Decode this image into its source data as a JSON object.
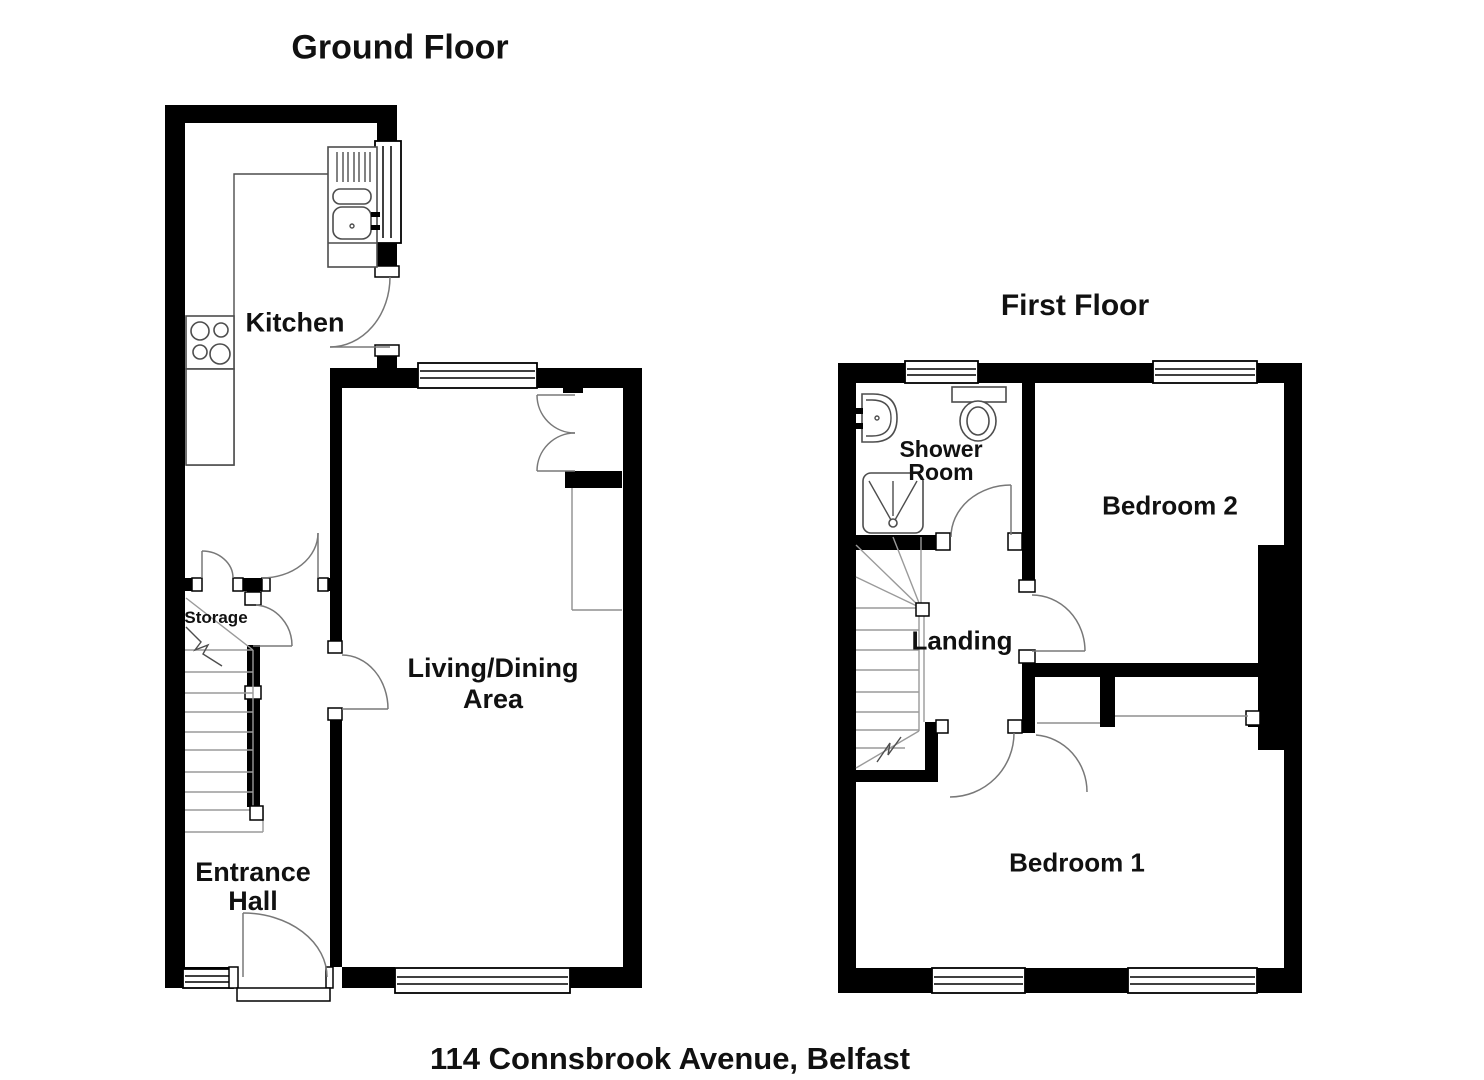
{
  "colors": {
    "background": "#ffffff",
    "walls": "#000000",
    "thin_lines": "#8f8f8f",
    "text": "#111111"
  },
  "address": "114 Connsbrook Avenue, Belfast",
  "ground_floor": {
    "title": "Ground Floor",
    "rooms": {
      "kitchen": {
        "label": "Kitchen"
      },
      "living": {
        "lines": [
          "Living/Dining",
          "Area"
        ]
      },
      "storage": {
        "label": "Storage"
      },
      "entrance": {
        "lines": [
          "Entrance",
          "Hall"
        ]
      }
    }
  },
  "first_floor": {
    "title": "First Floor",
    "rooms": {
      "shower": {
        "lines": [
          "Shower",
          "Room"
        ]
      },
      "bedroom2": {
        "label": "Bedroom 2"
      },
      "landing": {
        "label": "Landing"
      },
      "bedroom1": {
        "label": "Bedroom 1"
      }
    }
  }
}
